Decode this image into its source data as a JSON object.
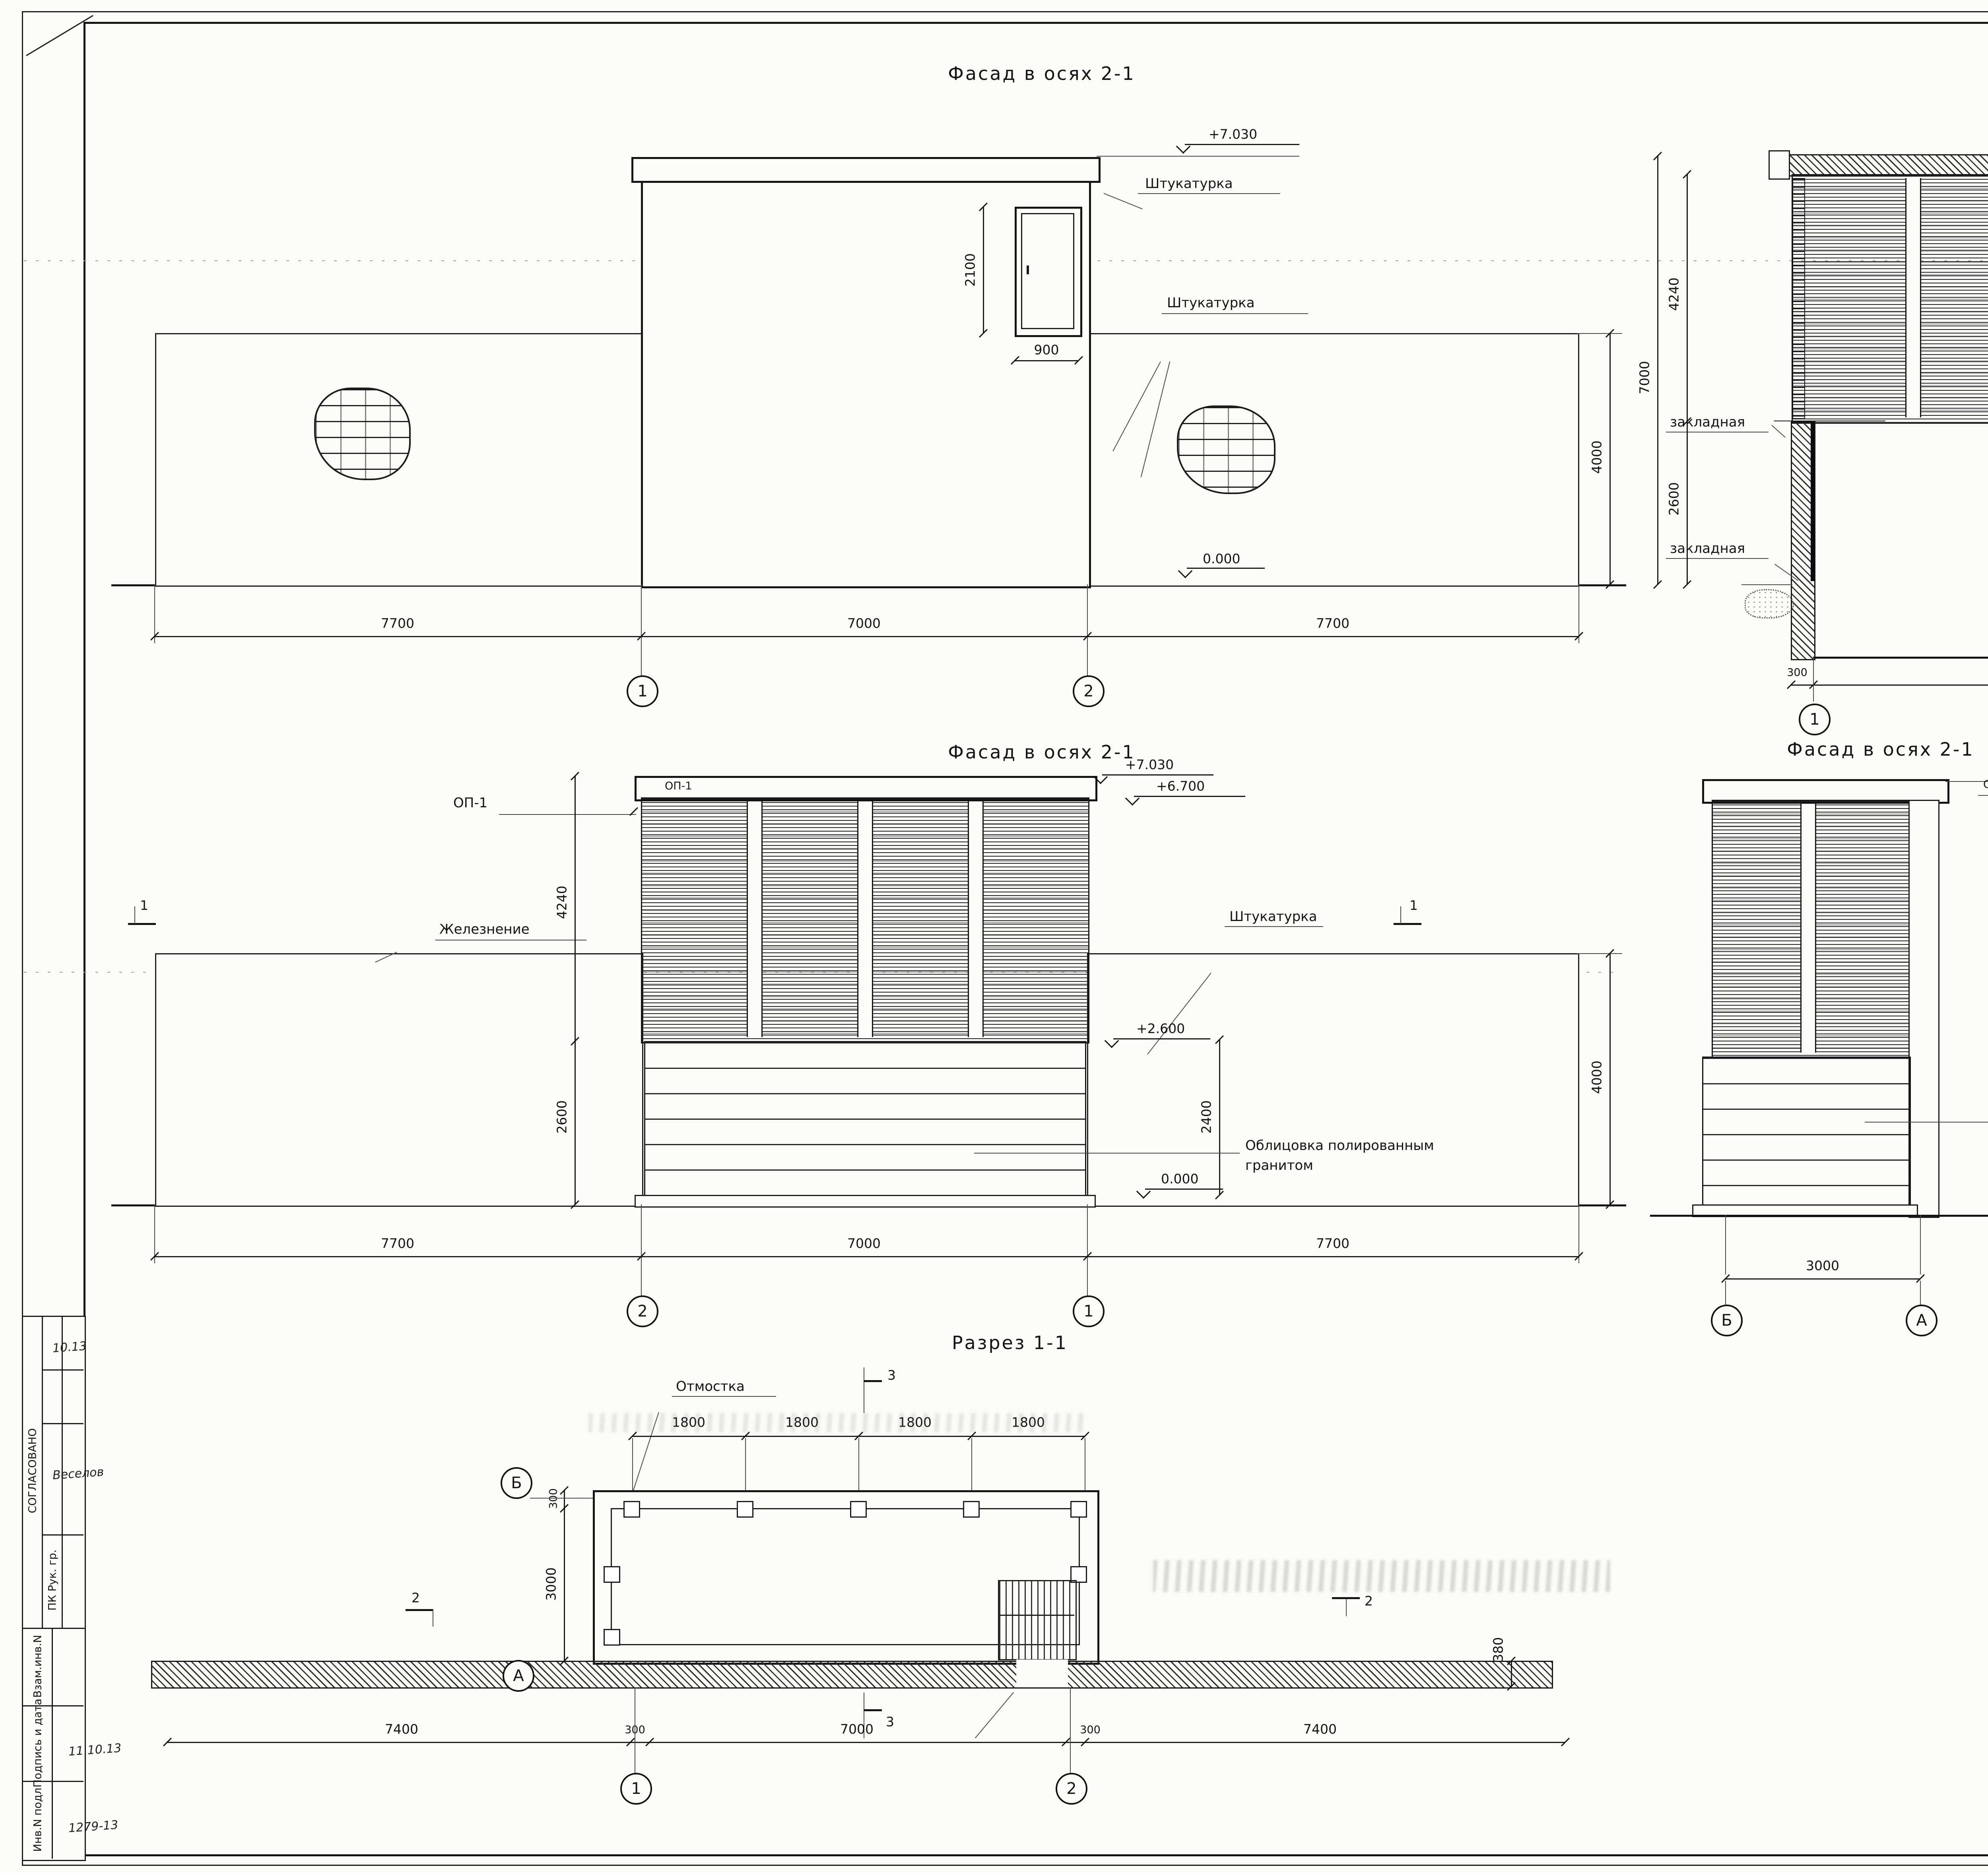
{
  "doc_number": "2815-4-73-2011-АС",
  "titles": {
    "fasad21": "Фасад в осях 2-1",
    "razrez22": "Разрез 2-2",
    "razrez33": "Разрез 3-3",
    "razrez11": "Разрез 1-1"
  },
  "labels": {
    "plaster": "Штукатурка",
    "embed": "закладная",
    "iron": "Железнение",
    "granite1": "Облицовка полированным",
    "granite2": "гранитом",
    "blind": "Отмостка",
    "op1": "ОП-1"
  },
  "elev": {
    "e7030": "+7.030",
    "e6700": "+6.700",
    "e6840": "+6.840",
    "e2600": "+2.600",
    "e0": "0.000"
  },
  "dims": {
    "d7700": "7700",
    "d7000": "7000",
    "d2100": "2100",
    "d900": "900",
    "d4000": "4000",
    "d300": "300",
    "d130": "130",
    "d1945": "1945",
    "d100": "100",
    "d2600": "2600",
    "d4240": "4240",
    "d3000": "3000",
    "d1800": "1800",
    "d7400": "7400",
    "d380": "380",
    "d2400": "2400"
  },
  "axes": {
    "a1": "1",
    "a2": "2",
    "aA": "А",
    "aB": "Б"
  },
  "marks": {
    "m1": "1",
    "m2": "2",
    "m3": "3"
  },
  "sidebar": {
    "agreed": "СОГЛАСОВАНО",
    "approver": "ПК Рук. гр.",
    "approver_sign": "Веселов",
    "approver_date": "10.13",
    "vzam": "Взам.инв.N",
    "podpis": "Подпись и дата",
    "podpis_value": "11.10.13",
    "inv": "Инв.N подл",
    "inv_value": "1279-13"
  },
  "titleblock": {
    "header": [
      "Изм.",
      "Кол.уч.",
      "Лист",
      "Nдок.",
      "Подпись",
      "Дата"
    ],
    "rows": [
      {
        "role": "Разраб.",
        "name": "Павлова",
        "date": "10.10.13"
      },
      {
        "role": "Рук.гр.",
        "name": "Виноградова",
        "date": "10.10.13"
      },
      {
        "role": "Гл.спец.",
        "name": "Ромашкин",
        "date": "10.10.13"
      },
      {
        "role": "Нач.отд.",
        "name": "Бойцов",
        "date": "10.10.13"
      },
      {
        "role": "Н.контр.",
        "name": "Шустрова",
        "date": "10.10.13"
      },
      {
        "role": "ГИП",
        "name": "Цупа",
        "date": "11.10.13"
      }
    ],
    "description1": "Строительство Лахтинско-Правобережной линии от станции \"Спасская\"",
    "description2": "до станции \"Морской Фасад\" для государственных нужд Санкт-Петербурга.",
    "description3": "Первый этап строительства участок от станции \"Спасская\" до станции",
    "description4": "\"Большой проспект\"",
    "object": "ВВУ ствола шахты N573.",
    "sheet_title1": "Фасад в осях 1-2, 2-1, А-Б",
    "sheet_title2": "Разрез 1-1, 2-2, 3-3",
    "stage_h": "Стадия",
    "list_h": "Лист",
    "lists_h": "Листов",
    "stage_v": "П",
    "company1": "ОАО",
    "company2": "ЛЕНМЕТРОГИПРОТРАНС",
    "logo_glyph": "Л"
  }
}
